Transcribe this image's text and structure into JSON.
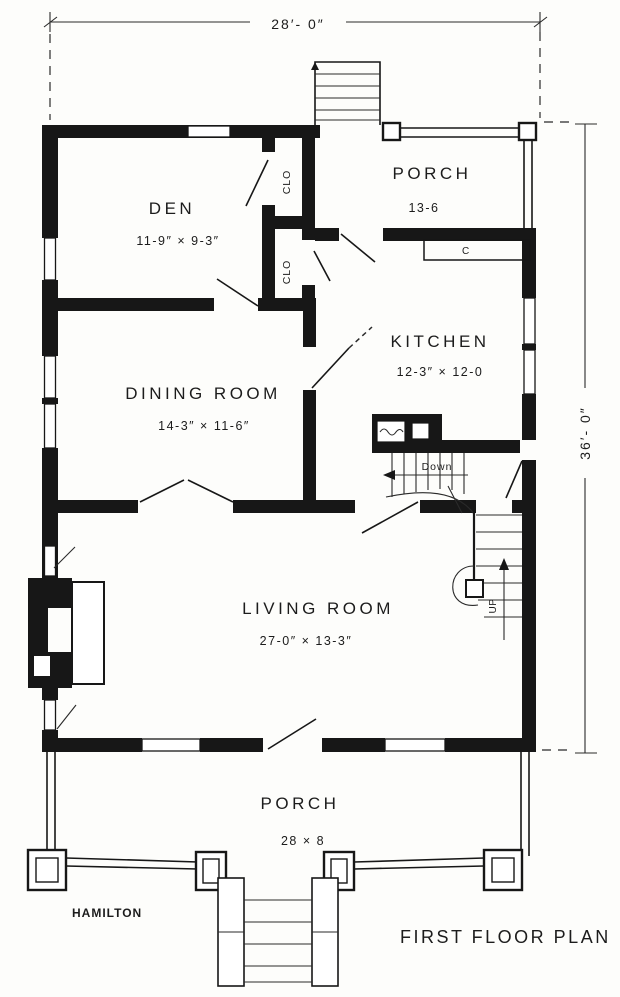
{
  "plan": {
    "title": "FIRST FLOOR PLAN",
    "architect": "HAMILTON",
    "overall_dimensions": {
      "width": "28′- 0″",
      "depth": "36′- 0″"
    },
    "rooms": {
      "den": {
        "name": "DEN",
        "size": "11-9″ × 9-3″"
      },
      "rear_porch": {
        "name": "PORCH",
        "size": "13-6"
      },
      "kitchen": {
        "name": "KITCHEN",
        "size": "12-3″ × 12-0"
      },
      "dining_room": {
        "name": "DINING ROOM",
        "size": "14-3″ × 11-6″"
      },
      "living_room": {
        "name": "LIVING ROOM",
        "size": "27-0″ × 13-3″"
      },
      "front_porch": {
        "name": "PORCH",
        "size": "28 × 8"
      }
    },
    "closets": {
      "upper": "CLO",
      "lower": "CLO"
    },
    "stairs": {
      "down": "Down",
      "up": "UP"
    },
    "fixtures": {
      "counter": "C"
    }
  }
}
